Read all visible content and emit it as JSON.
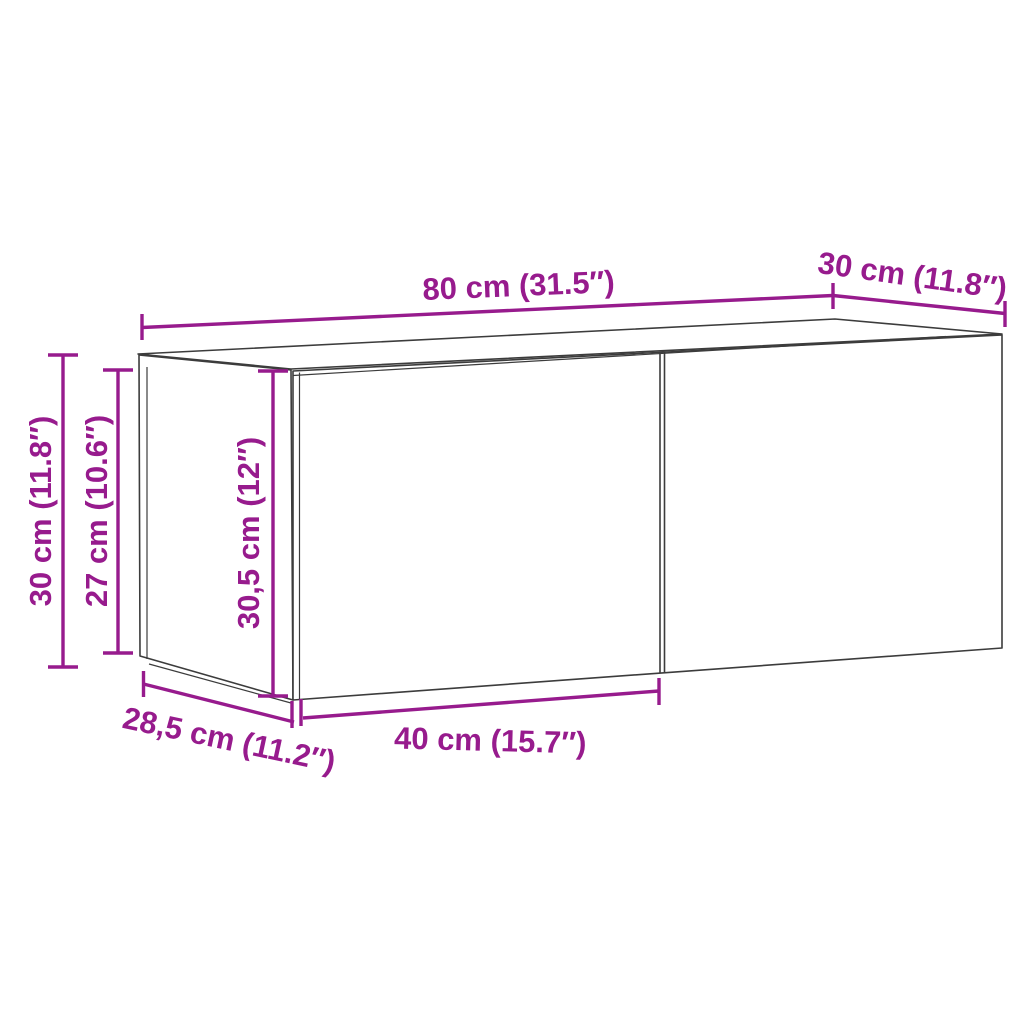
{
  "diagram": {
    "type": "furniture-dimension-diagram",
    "object": "wall-cabinet-two-doors",
    "dimensions": {
      "top_width": "80 cm (31.5″)",
      "top_depth": "30 cm (11.8″)",
      "left_height": "30 cm (11.8″)",
      "left_inner_height": "27 cm (10.6″)",
      "door_height": "30,5 cm (12″)",
      "bottom_depth": "28,5 cm (11.2″)",
      "bottom_door_width": "40 cm (15.7″)"
    }
  },
  "colors": {
    "accent": "#971b8d",
    "line": "#3c3c3c",
    "background": "#ffffff"
  }
}
